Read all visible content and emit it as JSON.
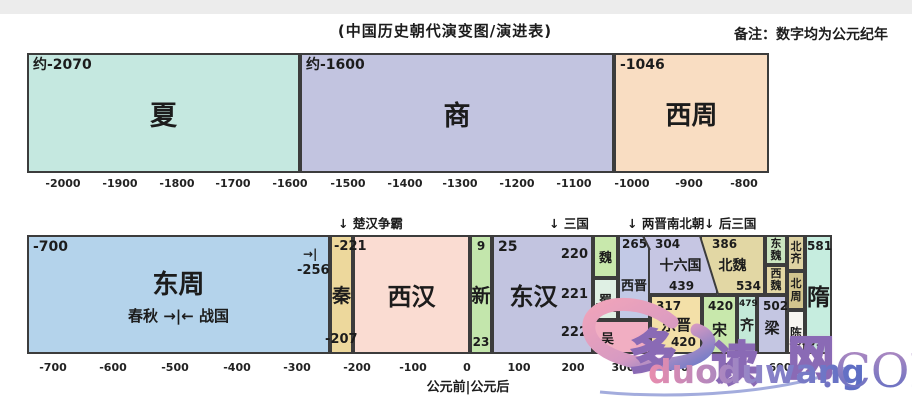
{
  "title": "(中国历史朝代演变图/演进表)",
  "note": "备注：数字均为公元纪年",
  "palette": {
    "xia": "#c5e8e0",
    "shang": "#c2c4e0",
    "xizhou": "#f9ddc2",
    "dongzhou": "#b4d3eb",
    "qin": "#edd89c",
    "xihan": "#fadcd2",
    "xin": "#c3e6ac",
    "donghan": "#c2c4e0",
    "wei": "#c8e8ac",
    "shu": "#dff0e4",
    "wu": "#f1aec2",
    "xijin": "#c2c9e6",
    "shiliuguo": "#c6c6e3",
    "beiwei": "#e2d7a4",
    "dongwei": "#cbe5c0",
    "xiwei": "#e2d7a4",
    "beiqi": "#ded2a2",
    "beizhou": "#d2c58e",
    "dongjin": "#f3e0a8",
    "song": "#c8e8ac",
    "qi": "#c3e9d8",
    "liang": "#c4c6e2",
    "chen": "#f7f5f0",
    "sui": "#c6eddf",
    "border": "#3c3c3c"
  },
  "band_bce": {
    "blocks": [
      {
        "label": "夏",
        "year": "约-2070"
      },
      {
        "label": "商",
        "year": "约-1600"
      },
      {
        "label": "西周",
        "year": "-1046"
      }
    ],
    "ticks": [
      "-2000",
      "-1900",
      "-1800",
      "-1700",
      "-1600",
      "-1500",
      "-1400",
      "-1300",
      "-1200",
      "-1100",
      "-1000",
      "-900",
      "-800"
    ]
  },
  "annotations": [
    {
      "text": "↓ 楚汉争霸"
    },
    {
      "text": "↓ 三国"
    },
    {
      "text": "↓ 两晋南北朝"
    },
    {
      "text": "↓ 后三国"
    }
  ],
  "main": {
    "dongzhou": {
      "year": "-700",
      "label": "东周",
      "sub": "春秋 →|← 战国",
      "end_arrow": "→|",
      "end_year": "-256"
    },
    "qin": {
      "start": "-221",
      "label": "秦",
      "end": "-207"
    },
    "xihan": {
      "label": "西汉"
    },
    "xin": {
      "start": "9",
      "label": "新",
      "end": "23"
    },
    "donghan": {
      "start": "25",
      "label": "东汉",
      "y220": "220",
      "y221": "221",
      "y222": "222"
    },
    "wei": {
      "label": "魏"
    },
    "shu": {
      "label": "蜀",
      "end": "263"
    },
    "wu": {
      "label": "吴"
    },
    "xijin": {
      "start": "265",
      "label": "西晋"
    },
    "shiliuguo": {
      "start": "304",
      "label": "十六国",
      "end": "439"
    },
    "beiwei": {
      "start": "386",
      "label": "北魏",
      "end": "534"
    },
    "dongwei": {
      "label": "东魏"
    },
    "xiwei": {
      "label": "西魏"
    },
    "beiqi": {
      "label": "北齐"
    },
    "beizhou": {
      "label": "北周"
    },
    "chen": {
      "label": "陈",
      "end": "589"
    },
    "dongjin": {
      "start": "317",
      "label": "东晋",
      "end": "420"
    },
    "song": {
      "start": "420",
      "label": "宋"
    },
    "qi": {
      "start": "479",
      "label": "齐"
    },
    "liang": {
      "start": "502",
      "label": "梁"
    },
    "sui": {
      "start": "581",
      "label": "隋",
      "end": "618"
    }
  },
  "axis_main": {
    "ticks": [
      "-700",
      "-600",
      "-500",
      "-400",
      "-300",
      "-200",
      "-100",
      "0",
      "100",
      "200",
      "300",
      "400",
      "500",
      "600"
    ],
    "era_label": "公元前|公元后"
  },
  "watermark": {
    "char1": "多",
    "char2": "读",
    "char3": "网",
    "latin": "duoduwang",
    "tld": ".COM"
  }
}
